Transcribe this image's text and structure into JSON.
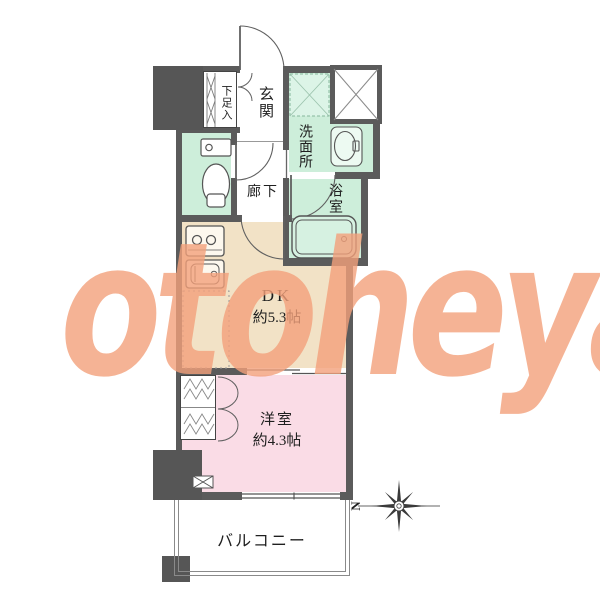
{
  "floorplan": {
    "rooms": {
      "shoe_storage": {
        "label": "下足入"
      },
      "genkan": {
        "label": "玄関"
      },
      "washroom": {
        "label": "洗面所"
      },
      "bathroom": {
        "label": "浴室"
      },
      "hallway": {
        "label": "廊下"
      },
      "dk": {
        "label": "DK",
        "size": "約5.3帖"
      },
      "western_room": {
        "label": "洋室",
        "size": "約4.3帖"
      },
      "balcony": {
        "label": "バルコニー"
      }
    },
    "compass": {
      "north_label": "N"
    },
    "icons": {
      "toilet": "toilet-icon",
      "bathtub": "bathtub-icon",
      "vanity_sink": "vanity-sink-icon",
      "stove": "stove-icon",
      "kitchen_sink": "kitchen-sink-icon",
      "laundry_pan": "laundry-pan-icon",
      "shoe_cabinet": "shoe-cabinet-icon",
      "closet": "closet-icon",
      "pipe_shaft": "pipe-shaft-icon",
      "ac_vent": "ac-vent-icon",
      "compass": "compass-rose-icon"
    },
    "colors": {
      "wall": "#5b5b5b",
      "wet_area_floor": "#cdeeda",
      "dk_floor": "#f2e2c6",
      "bedroom_floor": "#fadce6",
      "watermark": "#f2a17d"
    }
  },
  "watermark": {
    "text": "otoheya"
  }
}
